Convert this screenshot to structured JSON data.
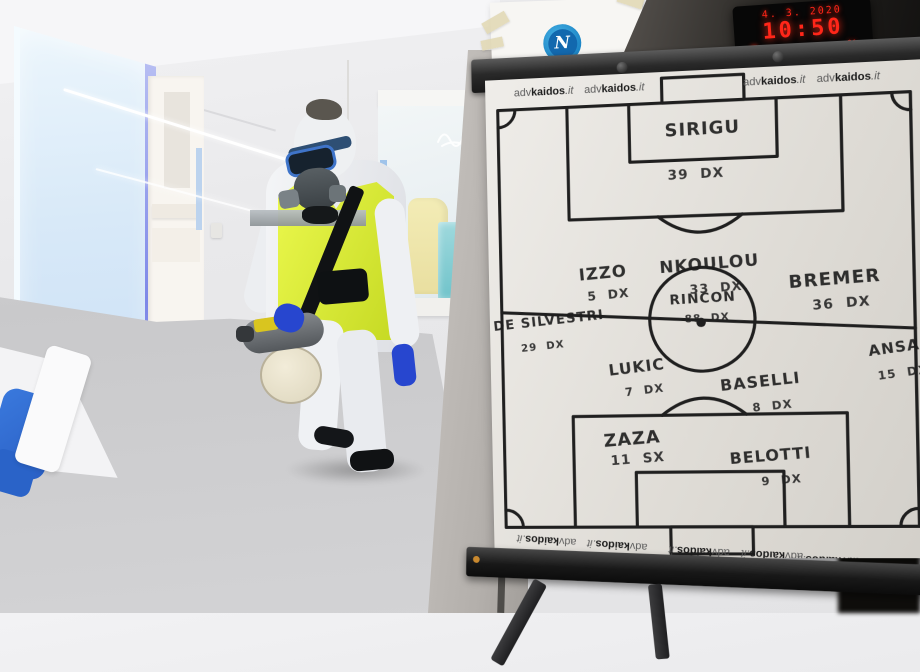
{
  "clock": {
    "date": "4. 3. 2020",
    "time": "10:50",
    "temp": "21"
  },
  "wifi_note": {
    "ssid_label": "SSID:",
    "ssid_value": "SPOG",
    "key_label": "Key:",
    "key_value": "ss",
    "badge_letter": "N"
  },
  "tactics_board": {
    "watermark": {
      "pre": "adv",
      "bold": "kaidos",
      "suffix": ".it",
      "marks": [
        {
          "x": 92,
          "y": 17,
          "rot": 0
        },
        {
          "x": 313,
          "y": 17,
          "rot": 0
        },
        {
          "x": 86,
          "y": 452,
          "rot": 184
        },
        {
          "x": 233,
          "y": 462,
          "rot": 183
        },
        {
          "x": 354,
          "y": 470,
          "rot": 182
        }
      ]
    },
    "players": [
      {
        "name": "SIRIGU",
        "number": "39",
        "side": "DX",
        "x": 210,
        "y": 62,
        "nx": 203,
        "ny": 104,
        "rot": -1,
        "fs": 17
      },
      {
        "name": "IZZO",
        "number": "5",
        "side": "DX",
        "x": 112,
        "y": 198,
        "nx": 117,
        "ny": 218,
        "rot": -4,
        "fs": 16
      },
      {
        "name": "NKOULOU",
        "number": "33",
        "side": "DX",
        "x": 214,
        "y": 192,
        "nx": 220,
        "ny": 214,
        "rot": -3,
        "fs": 16
      },
      {
        "name": "BREMER",
        "number": "36",
        "side": "DX",
        "x": 331,
        "y": 210,
        "nx": 337,
        "ny": 232,
        "rot": -3,
        "fs": 17
      },
      {
        "name": "DE SILVESTRI",
        "number": "29",
        "side": "DX",
        "x": 58,
        "y": 242,
        "nx": 52,
        "ny": 266,
        "rot": -5,
        "fs": 13
      },
      {
        "name": "RINCON",
        "number": "88",
        "side": "DX",
        "x": 207,
        "y": 224,
        "nx": 211,
        "ny": 242,
        "rot": -2,
        "fs": 13
      },
      {
        "name": "ANSALDI",
        "number": "15",
        "side": "DX/SX",
        "x": 399,
        "y": 274,
        "nx": 404,
        "ny": 297,
        "rot": -7,
        "fs": 14
      },
      {
        "name": "LUKIC",
        "number": "7",
        "side": "DX",
        "x": 143,
        "y": 290,
        "nx": 150,
        "ny": 311,
        "rot": -6,
        "fs": 15
      },
      {
        "name": "BASELLI",
        "number": "8",
        "side": "DX",
        "x": 260,
        "y": 306,
        "nx": 271,
        "ny": 328,
        "rot": -5,
        "fs": 15
      },
      {
        "name": "ZAZA",
        "number": "11",
        "side": "SX",
        "x": 137,
        "y": 360,
        "nx": 142,
        "ny": 378,
        "rot": -4,
        "fs": 17
      },
      {
        "name": "BELOTTI",
        "number": "9",
        "side": "DX",
        "x": 268,
        "y": 377,
        "nx": 278,
        "ny": 399,
        "rot": -4,
        "fs": 15
      }
    ]
  },
  "colors": {
    "hi_vis_vest": "#dce93a",
    "glove_blue": "#2746cf",
    "napoli_blue": "#1268ae",
    "led_red": "#ff2619",
    "marker": "#1c1c1c"
  }
}
